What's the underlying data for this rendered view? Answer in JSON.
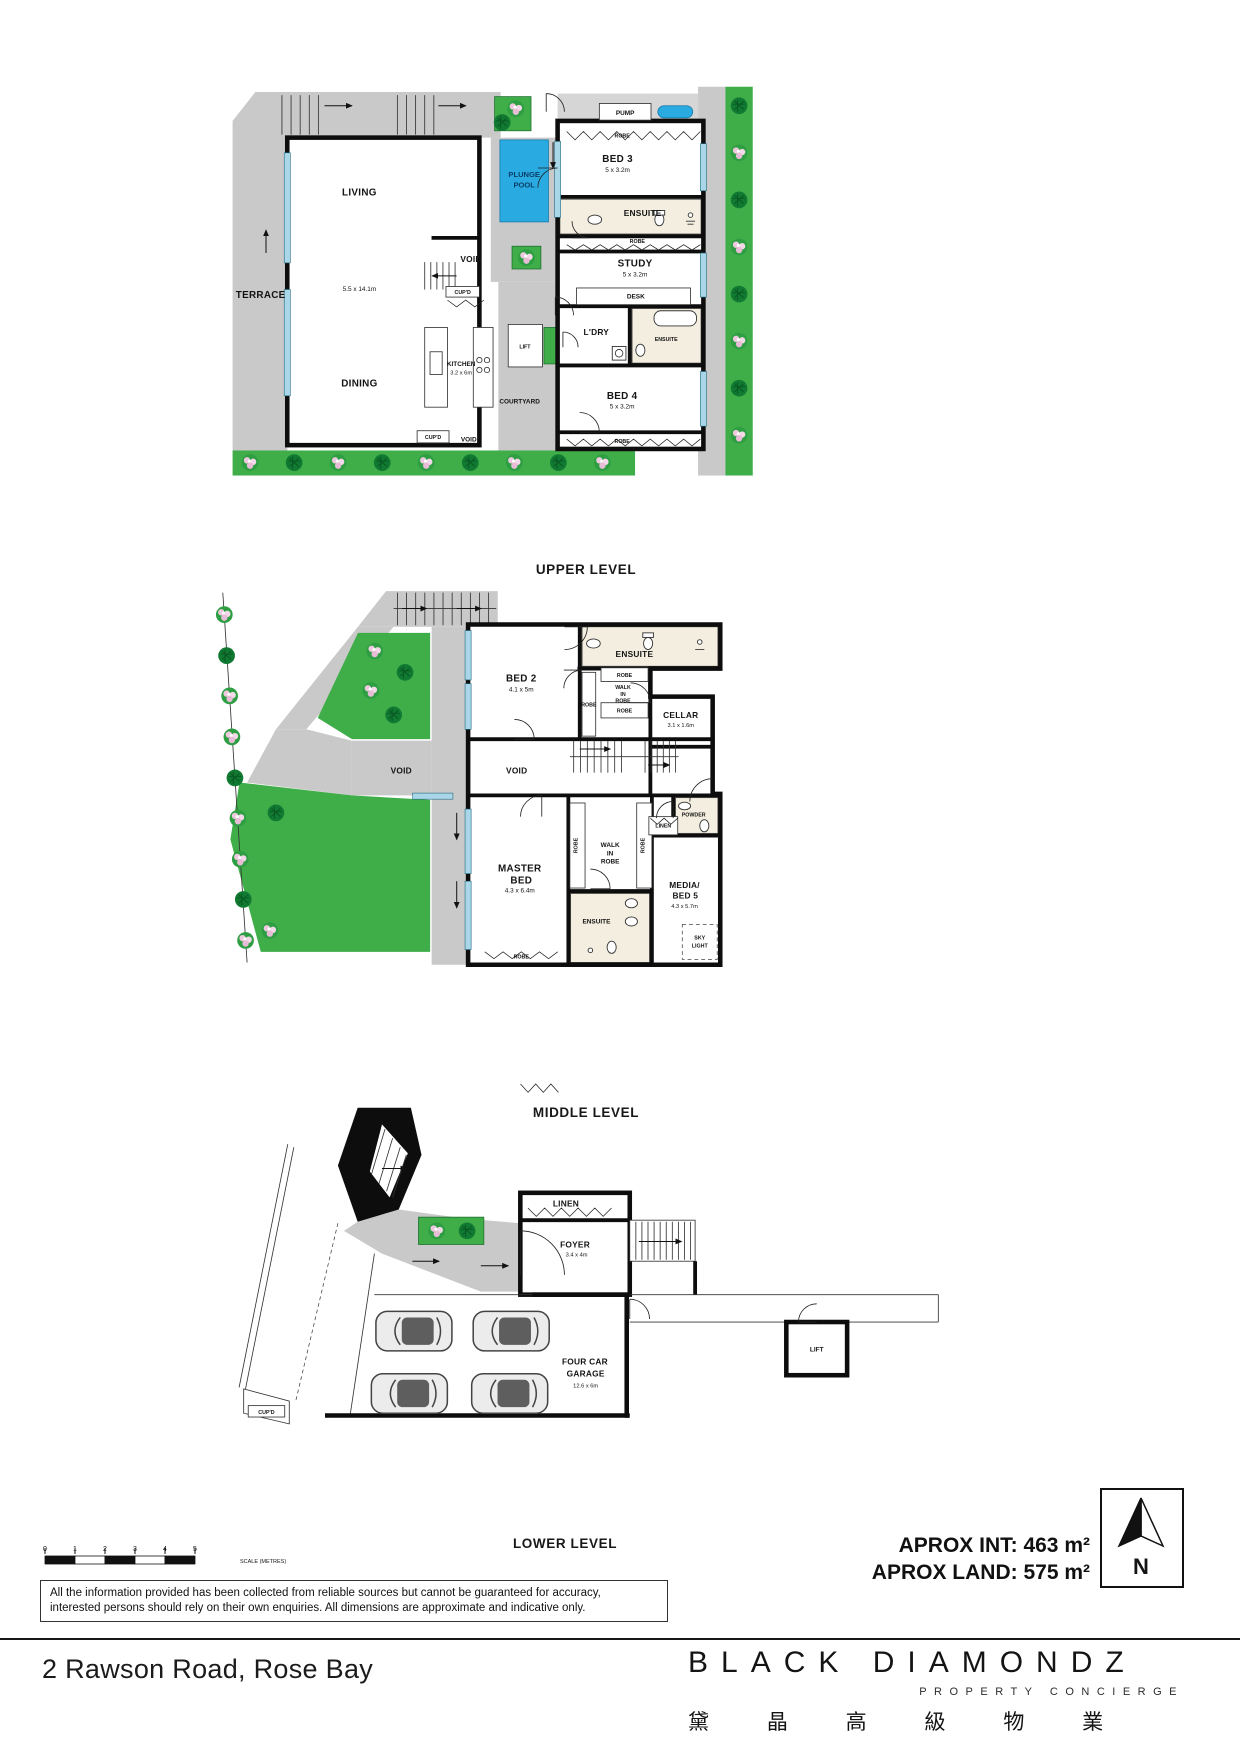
{
  "colors": {
    "wall": "#0d0d0d",
    "gray": "#c9c9c9",
    "green": "#3fae49",
    "pool": "#29abe2",
    "window": "#a9d7e8",
    "cream": "#f3eee0"
  },
  "captions": {
    "upper": "UPPER LEVEL",
    "middle": "MIDDLE LEVEL",
    "lower": "LOWER LEVEL"
  },
  "upper": {
    "living": {
      "label": "LIVING",
      "dim": "5.5 x 14.1m"
    },
    "terrace": "TERRACE",
    "dining": "DINING",
    "kitchen": {
      "label": "KITCHEN",
      "dim": "3.2 x 6m"
    },
    "courtyard": "COURTYARD",
    "void_stair": "VOID",
    "cupd_stair": "CUP'D",
    "void_bottom": "VOID",
    "cupd_bottom": "CUP'D",
    "lift": "LIFT",
    "pool": {
      "l1": "PLUNGE",
      "l2": "POOL"
    },
    "pump": "PUMP",
    "bed3": {
      "label": "BED 3",
      "dim": "5 x 3.2m"
    },
    "robe_bed3": "ROBE",
    "ensuite_bed3": "ENSUITE",
    "robe_study": "ROBE",
    "study": {
      "label": "STUDY",
      "dim": "5 x 3.2m"
    },
    "desk": "DESK",
    "ldry": "L'DRY",
    "ensuite_bed4": "ENSUITE",
    "bed4": {
      "label": "BED 4",
      "dim": "5 x 3.2m"
    },
    "robe_bed4": "ROBE"
  },
  "middle": {
    "bed2": {
      "label": "BED 2",
      "dim": "4.1 x 5m"
    },
    "ensuite_bed2": "ENSUITE",
    "robe_side": "ROBE",
    "wir1": {
      "top": "ROBE",
      "l1": "WALK",
      "l2": "IN",
      "l3": "ROBE",
      "bottom": "ROBE"
    },
    "cellar": {
      "label": "CELLAR",
      "dim": "3.1 x 1.6m"
    },
    "void_left": "VOID",
    "void_right": "VOID",
    "master": {
      "l1": "MASTER",
      "l2": "BED",
      "dim": "4.3 x 6.4m"
    },
    "wir2": {
      "l1": "WALK",
      "l2": "IN",
      "l3": "ROBE",
      "left": "ROBE",
      "right": "ROBE"
    },
    "ensuite_master": "ENSUITE",
    "linen": "LINEN",
    "powder": "POWDER",
    "media": {
      "l1": "MEDIA/",
      "l2": "BED 5",
      "dim": "4.3 x 5.7m"
    },
    "sky": {
      "l1": "SKY",
      "l2": "LIGHT"
    },
    "robe_master": "ROBE"
  },
  "lower": {
    "linen": "LINEN",
    "foyer": {
      "label": "FOYER",
      "dim": "3.4 x 4m"
    },
    "garage": {
      "l1": "FOUR CAR",
      "l2": "GARAGE",
      "dim": "12.6 x 6m"
    },
    "cupd": "CUP'D",
    "lift": "LIFT"
  },
  "footer": {
    "aprox_int": "APROX INT: 463 m²",
    "aprox_land": "APROX LAND: 575 m²",
    "north": "N",
    "scale": {
      "n0": "0",
      "n1": "1",
      "n2": "2",
      "n3": "3",
      "n4": "4",
      "n5": "5",
      "caption": "SCALE (METRES)"
    },
    "disclaimer1": "All the information provided has been collected from reliable sources but cannot be guaranteed for accuracy,",
    "disclaimer2": "interested persons should rely on their own enquiries. All dimensions are approximate and indicative only.",
    "address": "2 Rawson Road, Rose Bay",
    "brand": {
      "name": "BLACK DIAMONDZ",
      "sub": "PROPERTY CONCIERGE",
      "cn": "黛 晶 高 級 物 業"
    }
  }
}
